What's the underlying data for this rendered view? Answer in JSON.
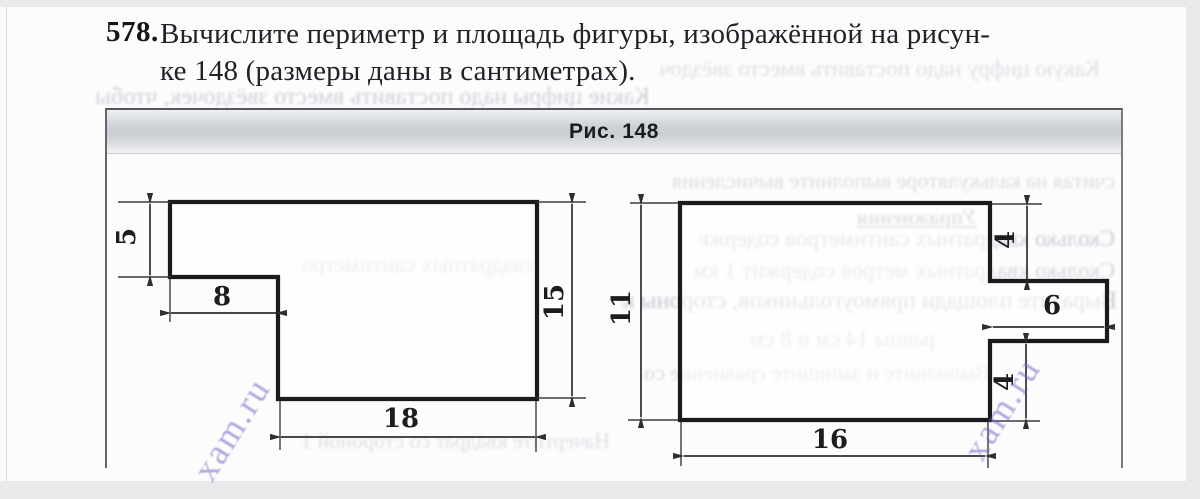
{
  "problem": {
    "number": "578.",
    "line1": "Вычислите периметр и площадь фигуры, изображённой на рисун-",
    "line2": "ке 148 (размеры даны в сантиметрах)."
  },
  "figure": {
    "caption": "Рис. 148",
    "units": "сантиметры",
    "dimensions": {
      "left_top_height": "5",
      "left_step_width": "8",
      "left_total_height": "15",
      "left_bottom_width": "18",
      "right_total_height": "11",
      "right_tab_top_offset": "4",
      "right_tab_width": "6",
      "right_tab_bottom_offset": "4",
      "right_bottom_width": "16"
    }
  },
  "watermark": {
    "text": "xam.ru"
  },
  "bleed": [
    {
      "text": "Какую цифру надо поставить вместо звёздочки"
    },
    {
      "text": "Какие цифры надо поставить вместо звёздочек, чтобы запись"
    },
    {
      "text": "1* + 3* + *5 = 111 оказалась верной"
    },
    {
      "text": "считая на калькуляторе выполните вычисления"
    },
    {
      "text": "Упражнения"
    },
    {
      "text": "Сколько квадратных сантиметров содержит 1 дм 1 м"
    },
    {
      "text": "квадратных сантиметров содержит 1 дм"
    },
    {
      "text": "Сколько квадратных метров содержит 1 км 1 га"
    },
    {
      "text": "Выразите площади прямоугольников, стороны которых"
    },
    {
      "text": "равны 14 см и 8 см"
    },
    {
      "text": "Выполните и запишите сравнение со сторонами"
    },
    {
      "text": "Начертите квадрат со стороной 10 см и сторон"
    }
  ]
}
